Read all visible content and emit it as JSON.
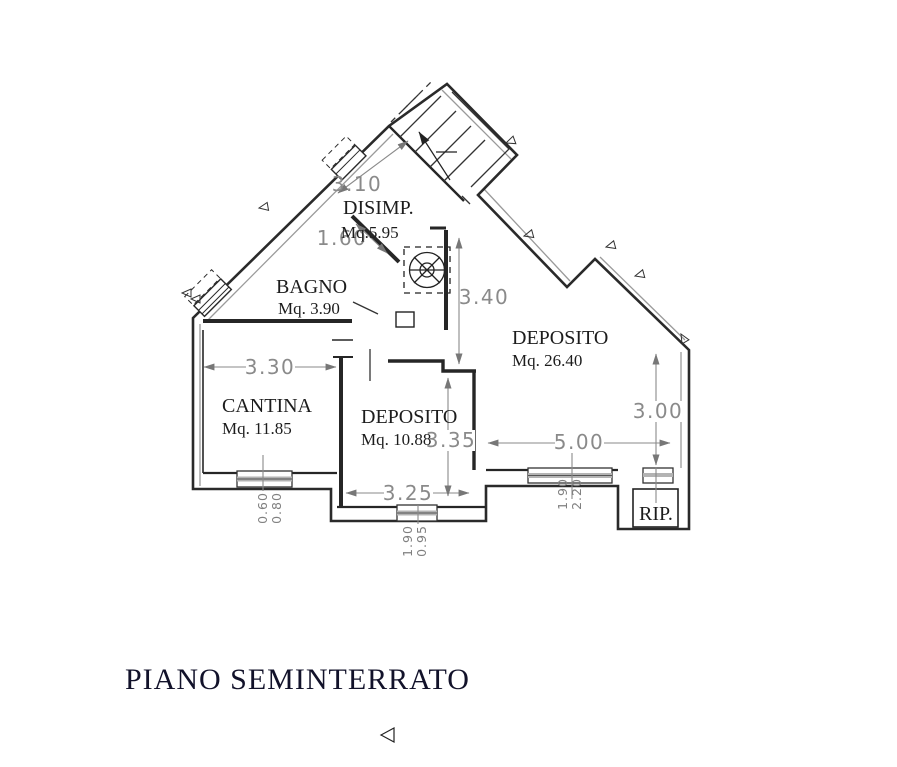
{
  "title": "PIANO SEMINTERRATO",
  "rooms": {
    "disimp": {
      "name": "DISIMP.",
      "area": "Mq.5.95"
    },
    "bagno": {
      "name": "BAGNO",
      "area": "Mq. 3.90"
    },
    "cantina": {
      "name": "CANTINA",
      "area": "Mq. 11.85"
    },
    "deposito_small": {
      "name": "DEPOSITO",
      "area": "Mq. 10.88"
    },
    "deposito_large": {
      "name": "DEPOSITO",
      "area": "Mq. 26.40"
    },
    "rip": {
      "name": "RIP."
    }
  },
  "dimensions": {
    "stairs_length": "3.10",
    "disimp_width": "1.60",
    "disimp_depth": "3.40",
    "cantina_width": "3.30",
    "deposito_small_depth": "3.35",
    "deposito_small_width": "3.25",
    "deposito_large_depth": "3.00",
    "deposito_large_width": "5.00"
  },
  "windows": {
    "cantina": {
      "width": "0.80",
      "height": "0.60"
    },
    "deposito_small": {
      "width": "0.95",
      "height": "1.90"
    },
    "deposito_large": {
      "width": "2.20",
      "height": "1.90"
    }
  },
  "colors": {
    "wall": "#2a2a2a",
    "dimension": "#8a8a8a",
    "title": "#12122a"
  }
}
